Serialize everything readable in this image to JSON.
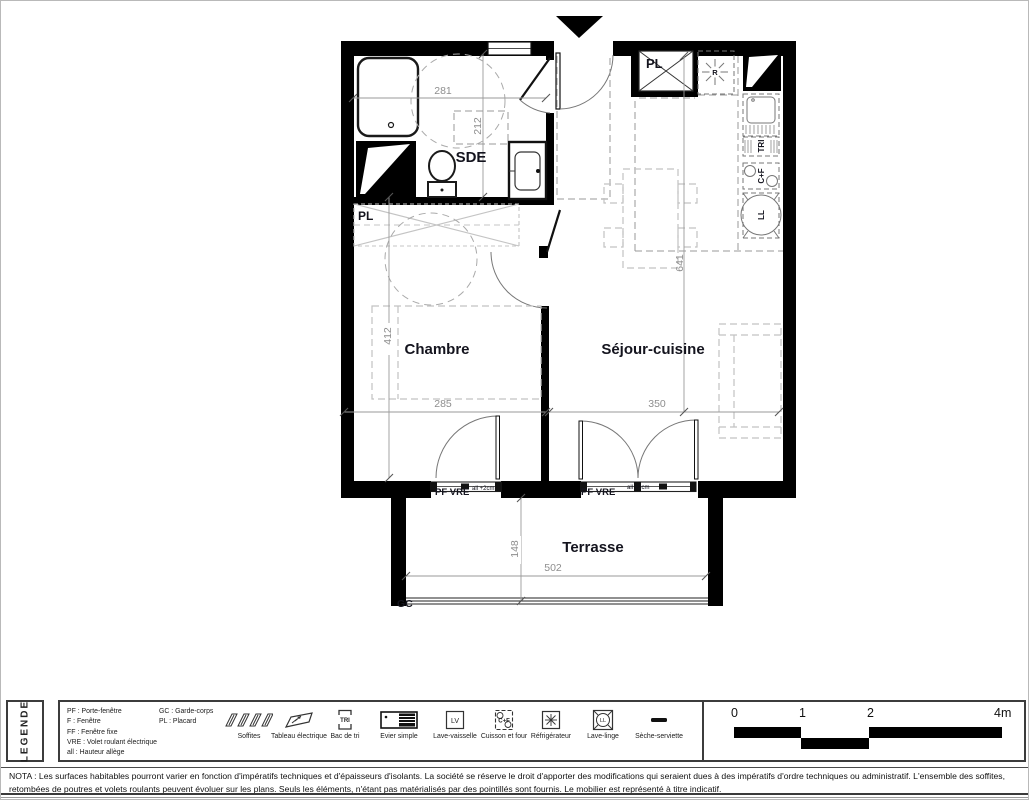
{
  "plan": {
    "rooms": {
      "sde": "SDE",
      "chambre": "Chambre",
      "sejour_cuisine": "Séjour-cuisine",
      "terrasse": "Terrasse"
    },
    "labels": {
      "pl_entry": "PL",
      "pl_corridor": "PL",
      "fridge": "R",
      "tri": "TRI",
      "cooktop_oven": "C+F",
      "washer": "LL",
      "guardrail": "GC",
      "pf_vre_chambre": "PF  VRE",
      "pf_vre_sejour": "PF  VRE",
      "allege_chambre": "all +2cm",
      "allege_sejour": "all +2cm"
    },
    "dimensions": {
      "sde_width": "281",
      "sde_depth": "212",
      "chambre_depth": "412",
      "chambre_width": "285",
      "sejour_width": "350",
      "sejour_depth": "641",
      "terrasse_depth": "148",
      "terrasse_width": "502"
    }
  },
  "legend": {
    "title": "LEGENDE",
    "abbreviations_col1": [
      "PF : Porte-fenêtre",
      "F : Fenêtre",
      "FF : Fenêtre fixe",
      "VRE : Volet roulant électrique",
      "all : Hauteur allège"
    ],
    "abbreviations_col2": [
      "GC : Garde-corps",
      "PL : Placard"
    ],
    "items": [
      {
        "label": "Soffites"
      },
      {
        "label": "Tableau électrique"
      },
      {
        "label": "Bac de tri"
      },
      {
        "label": "Evier simple"
      },
      {
        "label": "Lave-vaisselle"
      },
      {
        "label": "Cuisson et four"
      },
      {
        "label": "Réfrigérateur"
      },
      {
        "label": "Lave-linge"
      },
      {
        "label": "Sèche-serviette"
      }
    ],
    "icon_texts": {
      "tri": "TRI",
      "lv": "LV",
      "cf": "C+F",
      "ll": "LL"
    }
  },
  "scale_bar": {
    "t0": "0",
    "t1": "1",
    "t2": "2",
    "t4": "4m"
  },
  "nota": {
    "text": "NOTA : Les surfaces habitables pourront varier en fonction d'impératifs techniques et d'épaisseurs d'isolants. La société se réserve le droit d'apporter des modifications qui seraient dues à des impératifs d'ordre techniques ou administratif. L'ensemble des soffites, retombées de poutres et volets roulants peuvent évoluer sur les plans. Seuls les éléments, n'étant pas matérialisés par des pointillés sont fournis. Le mobilier est représenté à titre indicatif."
  }
}
